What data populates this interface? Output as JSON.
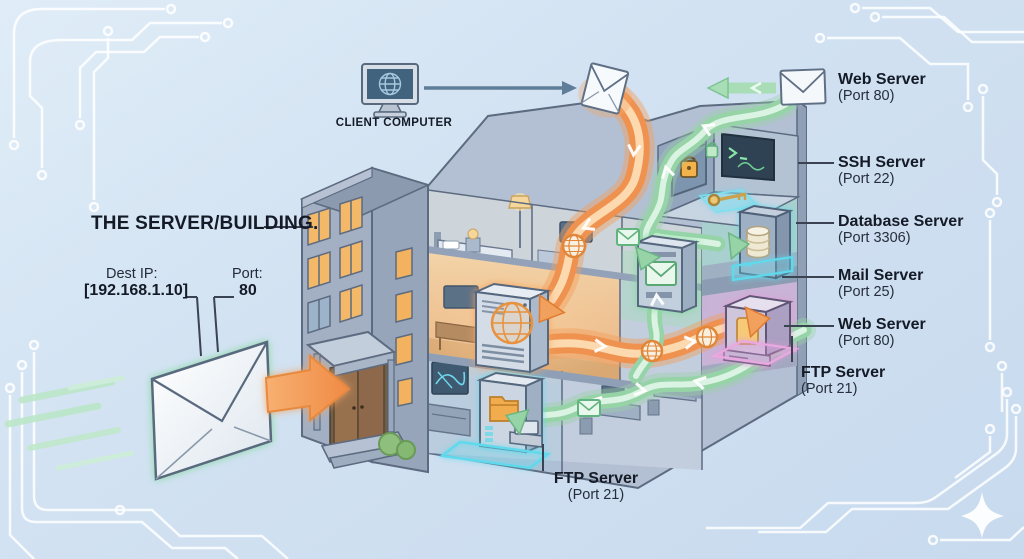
{
  "colors": {
    "background": "#d2e2f2",
    "ink": "#1a2030",
    "route_request_orange": "#f09a58",
    "route_response_green": "#95d5ab",
    "glow_cyan": "#5fd9ec",
    "glow_pink": "#e39ad8",
    "building_wall": "#a9b7cb",
    "window_lit": "#f4b968"
  },
  "client": {
    "label": "CLIENT COMPUTER",
    "icon": "monitor-globe-icon"
  },
  "building": {
    "label": "THE SERVER/BUILDING."
  },
  "packet": {
    "dest_ip_label": "Dest IP:",
    "dest_ip_value": "[192.168.1.10]",
    "port_label": "Port:",
    "port_value": "80",
    "icon": "envelope-icon"
  },
  "ports": {
    "web_top": {
      "name": "Web Server",
      "port": "(Port 80)",
      "icon": "envelope-icon"
    },
    "ssh": {
      "name": "SSH Server",
      "port": "(Port 22)",
      "icons": [
        "padlock-icon",
        "terminal-icon",
        "key-icon"
      ]
    },
    "database": {
      "name": "Database Server",
      "port": "(Port 3306)",
      "icon": "database-icon"
    },
    "mail": {
      "name": "Mail Server",
      "port": "(Port 25)",
      "icon": "envelope-icon"
    },
    "web_right": {
      "name": "Web Server",
      "port": "(Port 80)",
      "icon": "file-icon"
    },
    "ftp_right": {
      "name": "FTP Server",
      "port": "(Port 21)",
      "icon": "file-icon"
    },
    "ftp_bottom": {
      "name": "FTP Server",
      "port": "(Port 21)",
      "icon": "folder-icon"
    }
  }
}
